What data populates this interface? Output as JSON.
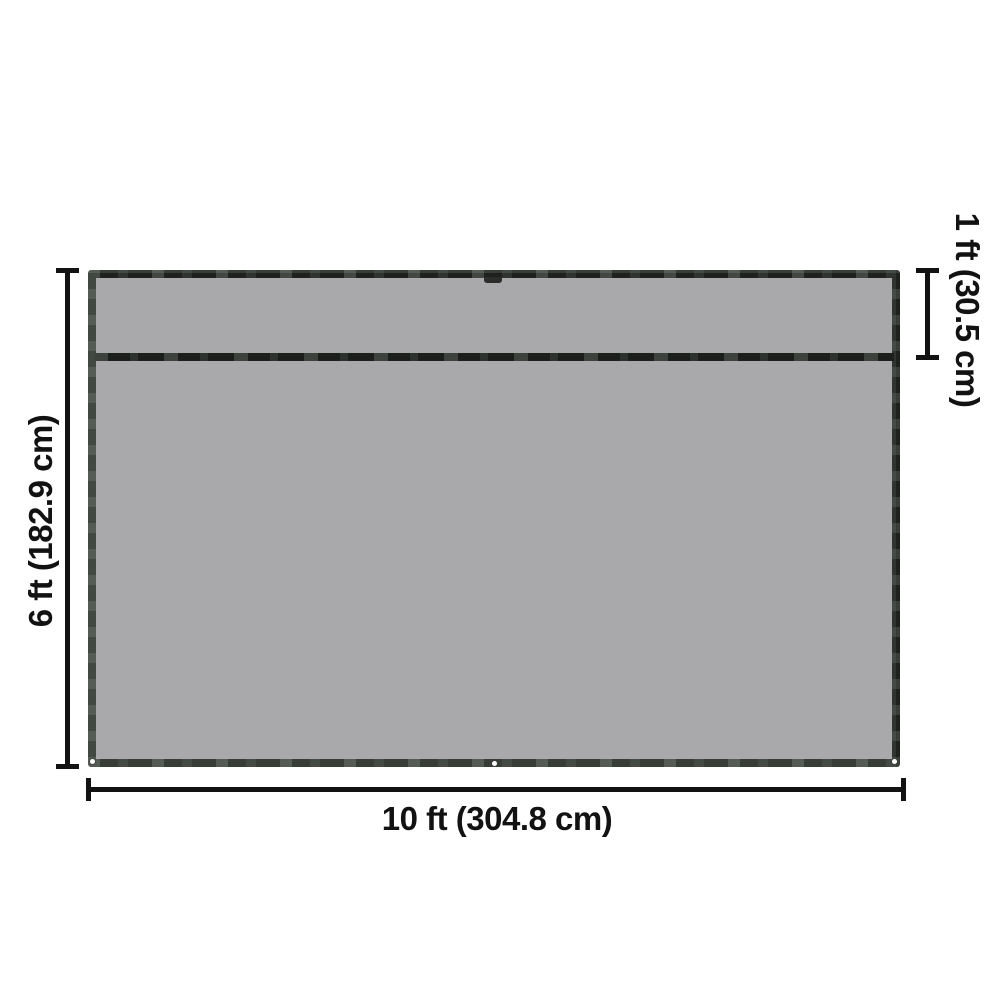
{
  "diagram": {
    "type": "product-dimension-diagram",
    "background": "#ffffff",
    "labels": {
      "height": "6 ft (182.9 cm)",
      "width": "10 ft (304.8 cm)",
      "flap": "1 ft (30.5 cm)"
    },
    "tarp": {
      "fill_color": "#a9a9ac",
      "edge_color": "#1e211e",
      "grommet_color": "#ffffff",
      "grommet_positions": [
        "bottom-left",
        "bottom-center",
        "bottom-right"
      ],
      "features": [
        "horizontal-seam-1ft-from-top",
        "top-center-tab",
        "stitched-dark-edging"
      ]
    },
    "annotation": {
      "line_color": "#121212",
      "text_color": "#121212"
    }
  }
}
